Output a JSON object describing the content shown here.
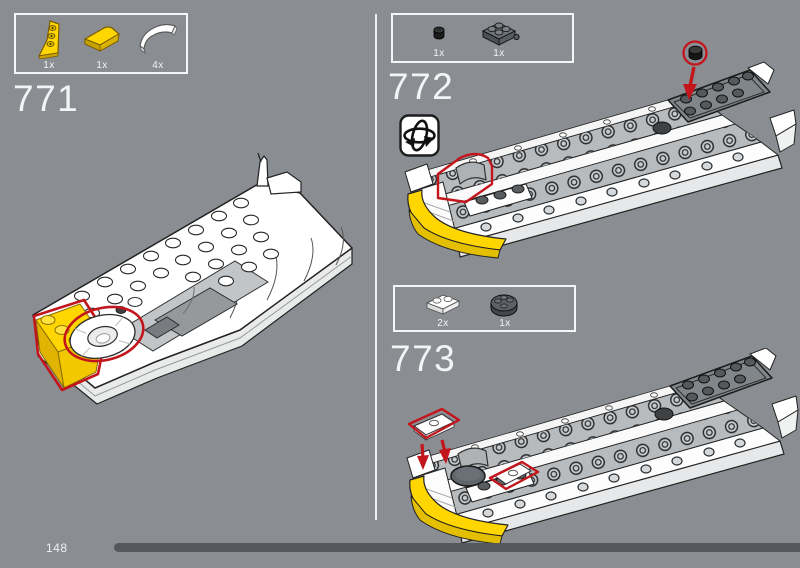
{
  "page": {
    "background_color": "#8a8e93",
    "divider": true
  },
  "colors": {
    "highlight_red": "#c3161c",
    "lego_yellow": "#ffd600",
    "box_border_white": "#f4f6f7",
    "progress_bar": "#54575b"
  },
  "steps": {
    "s771": {
      "number": "771",
      "parts": [
        {
          "icon": "yellow-wedge-plate-icon",
          "count": "1x"
        },
        {
          "icon": "yellow-curved-slope-icon",
          "count": "1x"
        },
        {
          "icon": "white-curved-slope-icon",
          "count": "4x"
        }
      ]
    },
    "s772": {
      "number": "772",
      "rotate_hint_icon": "rotate-model-icon",
      "parts": [
        {
          "icon": "black-round-plate-1x1-icon",
          "count": "1x"
        },
        {
          "icon": "dark-gray-plate-2x2-icon",
          "count": "1x"
        }
      ]
    },
    "s773": {
      "number": "773",
      "parts": [
        {
          "icon": "white-plate-1x2-icon",
          "count": "2x"
        },
        {
          "icon": "dark-gray-round-plate-2x2-icon",
          "count": "1x"
        }
      ]
    }
  },
  "footer": {
    "page_number": "148"
  }
}
